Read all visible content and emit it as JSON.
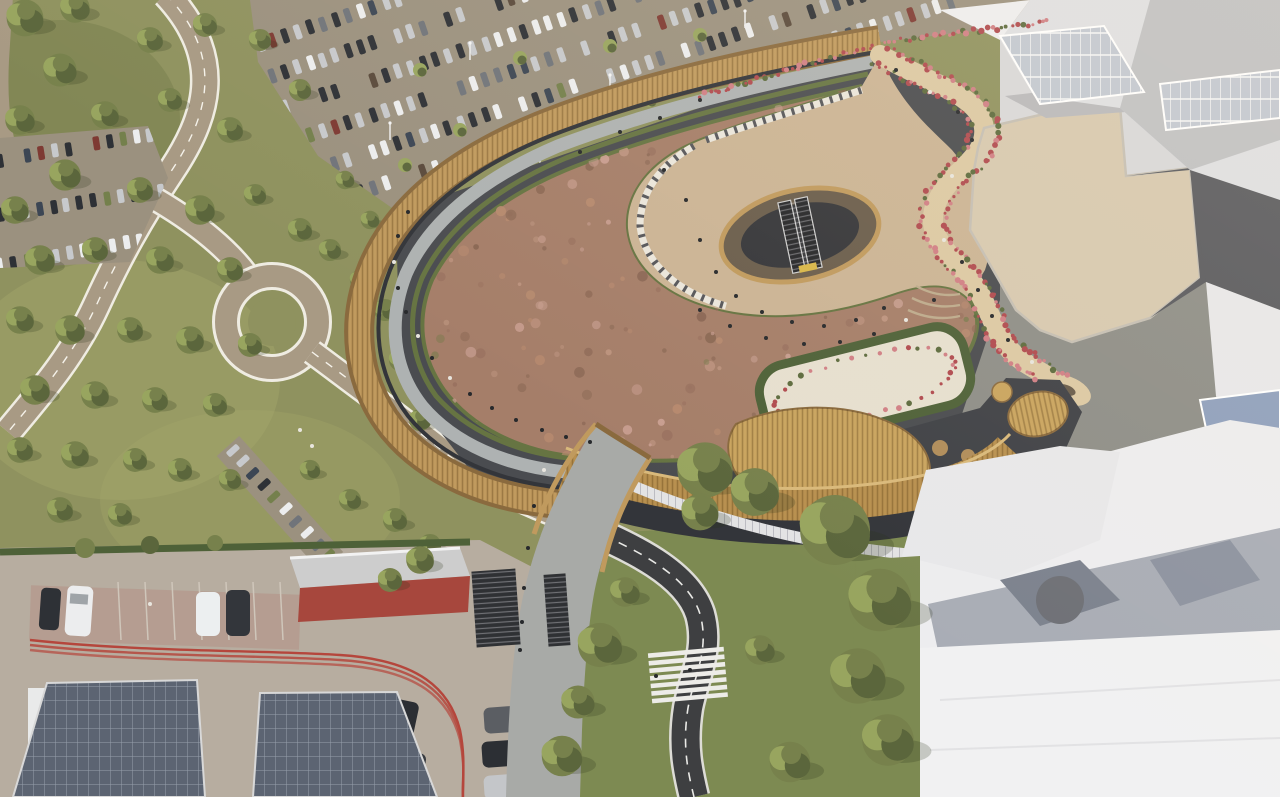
{
  "scene": {
    "type": "aerial-architectural-rendering",
    "description": "Aerial CGI rendering of a shopping centre extension: curved building with reddish sedum green roof and timber-deck promenade, sunken rooftop plaza with escalators, serpentine flower-lined walkway, sand-coloured roof terrace, surrounding parking lots full of cars, winding access roads through trees, pedestrian bridge and stair path to a road with zebra crossing, service yard with solar-panel canopies and red building, and white massing buildings of the existing mall",
    "regions": [
      "greenfield-with-trees",
      "access-road-network",
      "north-parking-lot",
      "west-parking-lot",
      "mall-building",
      "green-sedum-roof",
      "timber-promenade",
      "rooftop-plaza",
      "escalator-well",
      "serpentine-walkway",
      "roof-terrace",
      "hedge-courtyard",
      "wicker-canopy",
      "timber-slat-facade",
      "construction-hoarding",
      "existing-mall-white-buildings",
      "south-road",
      "zebra-crossing",
      "pedestrian-bridge-path",
      "service-yard",
      "solar-canopies",
      "red-service-building",
      "pedestrians"
    ]
  },
  "palette": {
    "grassBase": "#8f925f",
    "grassLight": "#a3a66b",
    "grassDark": "#6f7747",
    "grassBottom": "#7d8a52",
    "treeGreen": "#77814c",
    "treeDark": "#5b663c",
    "treeLight": "#98a55f",
    "roadTan": "#a89a84",
    "roadEdge": "#efece2",
    "lotAsphalt": "#9b917f",
    "asphaltDark": "#3e3f41",
    "roadMark": "#e9e9e6",
    "woodParapet": "#8a6a3e",
    "woodDeck": "#c09a5e",
    "woodSlat": "#b8904f",
    "woodLight": "#d9b97b",
    "grayWalk": "#aeb2b2",
    "hedge": "#667442",
    "hedgeDark": "#4e6138",
    "sedumBase": "#a57e69",
    "sedumLight": "#bd9480",
    "sedumDark": "#8a6754",
    "sedumPink": "#c99f92",
    "sedumGreen": "#7b7a4e",
    "plaza": "#cbb495",
    "plazaLight": "#d8c4a8",
    "walkwaySand": "#dcc9a4",
    "terraceSand": "#d7c9b0",
    "flowerRed": "#b04a4f",
    "flowerPink": "#d07f85",
    "wallDark": "#4a4c50",
    "wallDarker": "#33353a",
    "whiteBldg": "#ededef",
    "whiteBldgLight": "#f1f1f2",
    "whiteShade": "#a6a7ac",
    "grayRoof": "#b9b9bc",
    "grayShadow": "#595a5f",
    "glassBlue": "#c2c8d2",
    "glassDark": "#8fa0bd",
    "concreteYard": "#b7ada0",
    "redBldg": "#a7473d",
    "redTrack": "#b5463c",
    "solarPanel": "#5c6472",
    "solarGrid": "#97a0ac",
    "fenceWhite": "#e3e3e4",
    "paver": "#a8aaa7",
    "stairDark": "#2f3134",
    "personDark": "#27292c",
    "personLight": "#e8e5de",
    "carColors": [
      "#c7c9cc",
      "#ecedee",
      "#2e3136",
      "#70747a",
      "#3c4654",
      "#7e3a33",
      "#74804c",
      "#5a4a3c"
    ]
  }
}
